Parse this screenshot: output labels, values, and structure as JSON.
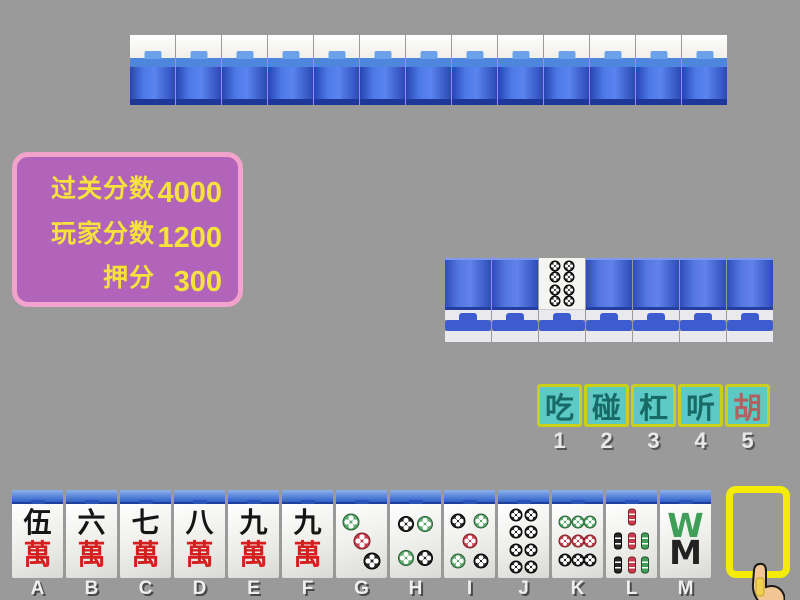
{
  "background_color": "#9a9a9a",
  "score_panel": {
    "bg_color": "#b164b9",
    "border_color": "#f2a3cb",
    "text_color": "#f6e23c",
    "rows": [
      {
        "label": "过关分数",
        "value": "4000"
      },
      {
        "label": "玩家分数",
        "value": "1200"
      },
      {
        "label": "押分",
        "value": "300"
      }
    ]
  },
  "opponent_wall": {
    "tile_count": 13,
    "state": "face-down"
  },
  "meld_row": {
    "tiles": [
      "back",
      "back",
      "8-dots-face-up",
      "back",
      "back",
      "back",
      "back"
    ],
    "face_up_tile": {
      "name": "8-dots",
      "dots": 8
    }
  },
  "actions": {
    "bg_color": "#5cc9c4",
    "border_color": "#c9d01a",
    "text_color": "#186a66",
    "hu_text_color": "#b26060",
    "buttons": [
      {
        "label": "吃",
        "number": "1",
        "highlight": false
      },
      {
        "label": "碰",
        "number": "2",
        "highlight": false
      },
      {
        "label": "杠",
        "number": "3",
        "highlight": false
      },
      {
        "label": "听",
        "number": "4",
        "highlight": false
      },
      {
        "label": "胡",
        "number": "5",
        "highlight": true
      }
    ]
  },
  "hand": {
    "tiles": [
      {
        "letter": "A",
        "name": "5-man",
        "top_char": "伍",
        "bottom_char": "萬"
      },
      {
        "letter": "B",
        "name": "6-man",
        "top_char": "六",
        "bottom_char": "萬"
      },
      {
        "letter": "C",
        "name": "7-man",
        "top_char": "七",
        "bottom_char": "萬"
      },
      {
        "letter": "D",
        "name": "8-man",
        "top_char": "八",
        "bottom_char": "萬"
      },
      {
        "letter": "E",
        "name": "9-man",
        "top_char": "九",
        "bottom_char": "萬"
      },
      {
        "letter": "F",
        "name": "9-man",
        "top_char": "九",
        "bottom_char": "萬"
      },
      {
        "letter": "G",
        "name": "3-dots",
        "dots": 3
      },
      {
        "letter": "H",
        "name": "4-dots",
        "dots": 4
      },
      {
        "letter": "I",
        "name": "5-dots",
        "dots": 5
      },
      {
        "letter": "J",
        "name": "8-dots",
        "dots": 8
      },
      {
        "letter": "K",
        "name": "9-dots",
        "dots": 9
      },
      {
        "letter": "L",
        "name": "7-bamboo",
        "bamboo": 7
      },
      {
        "letter": "M",
        "name": "8-bamboo",
        "glyphs": [
          "W",
          "M"
        ]
      }
    ]
  },
  "draw_slot": {
    "border_color": "#f4ec08",
    "state": "empty"
  },
  "cursor": {
    "type": "pointing-hand"
  }
}
